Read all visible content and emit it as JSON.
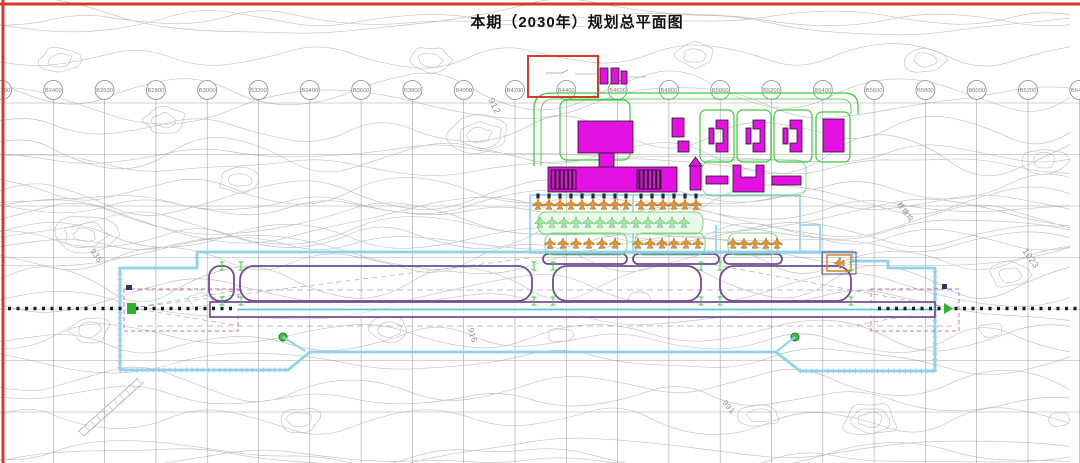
{
  "title": "本期（2030年）规划总平面图",
  "grid": {
    "labels": [
      "B2200",
      "B2400",
      "B2600",
      "B2800",
      "B3000",
      "B3200",
      "B3400",
      "B3600",
      "B3800",
      "B4000",
      "B4200",
      "B4400",
      "B4600",
      "B4800",
      "B5000",
      "B5200",
      "B5400",
      "B5600",
      "B5800",
      "B6000",
      "B6200",
      "B6400"
    ],
    "first_x": 2,
    "spacing": 51.3,
    "circle_y": 90,
    "h_lines": [
      103,
      154.5,
      206,
      257.5,
      309,
      360.5,
      412
    ]
  },
  "map_labels": [
    {
      "text": "912",
      "x": 488,
      "y": 100,
      "rot": 63,
      "size": 9
    },
    {
      "text": "935",
      "x": 90,
      "y": 251,
      "rot": 55,
      "size": 8
    },
    {
      "text": "916",
      "x": 468,
      "y": 329,
      "rot": 73,
      "size": 8
    },
    {
      "text": "991",
      "x": 722,
      "y": 403,
      "rot": 50,
      "size": 8
    },
    {
      "text": "1023",
      "x": 1022,
      "y": 251,
      "rot": 55,
      "size": 9
    },
    {
      "text": "桂塘坞",
      "x": 897,
      "y": 204,
      "rot": 55,
      "size": 7
    }
  ],
  "colors": {
    "frame": "#d23b2e",
    "building": "#e312e3",
    "buildingOutline": "#1a1a1a",
    "green": "#3ecb3e",
    "greenLight": "#7fd87f",
    "orangePlane": "#e6952f",
    "cyanBoundary": "#8ed2ec",
    "purpleTaxiway": "#6f4b94",
    "gridGray": "#8f8f8f",
    "contourGray": "#c2c2c2",
    "centerlineBlack": "#1b1b1b"
  },
  "buildings": [
    {
      "shape": "rect",
      "x": 578,
      "y": 121,
      "w": 55,
      "h": 32,
      "name": "terminal-garage"
    },
    {
      "shape": "rect",
      "x": 599,
      "y": 153,
      "w": 15,
      "h": 15,
      "name": "terminal-connector"
    },
    {
      "shape": "rect",
      "x": 548,
      "y": 167,
      "w": 129,
      "h": 25,
      "name": "terminal-main-hall"
    },
    {
      "shape": "hatch",
      "x": 551,
      "y": 170,
      "w": 25,
      "h": 19,
      "name": "terminal-west-pier"
    },
    {
      "shape": "hatch",
      "x": 637,
      "y": 170,
      "w": 24,
      "h": 19,
      "name": "terminal-east-pier"
    },
    {
      "shape": "rect",
      "x": 672,
      "y": 118,
      "w": 12,
      "h": 19,
      "name": "support-building"
    },
    {
      "shape": "rect",
      "x": 678,
      "y": 141,
      "w": 11,
      "h": 11,
      "name": "support-building"
    },
    {
      "shape": "rect",
      "x": 600,
      "y": 68,
      "w": 8,
      "h": 16,
      "name": "north-building"
    },
    {
      "shape": "rect",
      "x": 611,
      "y": 68,
      "w": 8,
      "h": 16,
      "name": "north-building"
    },
    {
      "shape": "rect",
      "x": 621,
      "y": 71,
      "w": 6,
      "h": 13,
      "name": "north-building"
    },
    {
      "shape": "rect",
      "x": 709,
      "y": 128,
      "w": 5,
      "h": 16,
      "name": "campus-building"
    },
    {
      "shape": "c",
      "x": 716,
      "y": 120,
      "w": 12,
      "h": 32,
      "name": "campus-building"
    },
    {
      "shape": "rect",
      "x": 746,
      "y": 128,
      "w": 5,
      "h": 16,
      "name": "campus-building"
    },
    {
      "shape": "c",
      "x": 753,
      "y": 120,
      "w": 12,
      "h": 32,
      "name": "campus-building"
    },
    {
      "shape": "rect",
      "x": 783,
      "y": 128,
      "w": 5,
      "h": 16,
      "name": "campus-building"
    },
    {
      "shape": "c",
      "x": 790,
      "y": 120,
      "w": 12,
      "h": 32,
      "name": "campus-building"
    },
    {
      "shape": "rect",
      "x": 823,
      "y": 119,
      "w": 21,
      "h": 33,
      "name": "campus-building"
    },
    {
      "shape": "tower",
      "x": 690,
      "y": 166,
      "w": 11,
      "h": 24,
      "name": "control-tower"
    },
    {
      "shape": "rect",
      "x": 706,
      "y": 176,
      "w": 22,
      "h": 8,
      "name": "airside-building"
    },
    {
      "shape": "u",
      "x": 733,
      "y": 165,
      "w": 31,
      "h": 27,
      "name": "airside-building"
    },
    {
      "shape": "rect",
      "x": 772,
      "y": 176,
      "w": 29,
      "h": 9,
      "name": "airside-building"
    }
  ],
  "aircraft_rows": [
    {
      "name": "contact-stands-row",
      "fill": "#e6952f",
      "stroke": "#935f15",
      "y": 204,
      "bridges": true,
      "xs": [
        538,
        549,
        560,
        571,
        582,
        593,
        604,
        615,
        626,
        641,
        652,
        663,
        674,
        685,
        696
      ]
    },
    {
      "name": "remote-stands-row",
      "fill": "#aee8ae",
      "stroke": "#4fae4f",
      "y": 222,
      "xs": [
        540,
        552,
        564,
        576,
        588,
        600,
        612,
        624,
        636,
        648,
        660,
        672,
        684
      ]
    },
    {
      "name": "south-stands-row",
      "fill": "#e6952f",
      "stroke": "#935f15",
      "y": 243,
      "xs": [
        550,
        563,
        576,
        589,
        602,
        615,
        638,
        650,
        662,
        674,
        686,
        698,
        733,
        744,
        755,
        766,
        777
      ]
    },
    {
      "name": "runup-pad-stand",
      "fill": "#e6952f",
      "stroke": "#935f15",
      "y": 263,
      "rot": -90,
      "xs": [
        839
      ]
    }
  ],
  "taxiway_junction_marks": [
    [
      222,
      266
    ],
    [
      222,
      301
    ],
    [
      241,
      266
    ],
    [
      241,
      301
    ],
    [
      534,
      266
    ],
    [
      534,
      301
    ],
    [
      553,
      266
    ],
    [
      553,
      301
    ],
    [
      701,
      266
    ],
    [
      701,
      301
    ],
    [
      720,
      266
    ],
    [
      720,
      301
    ],
    [
      851,
      266
    ],
    [
      851,
      301
    ]
  ]
}
